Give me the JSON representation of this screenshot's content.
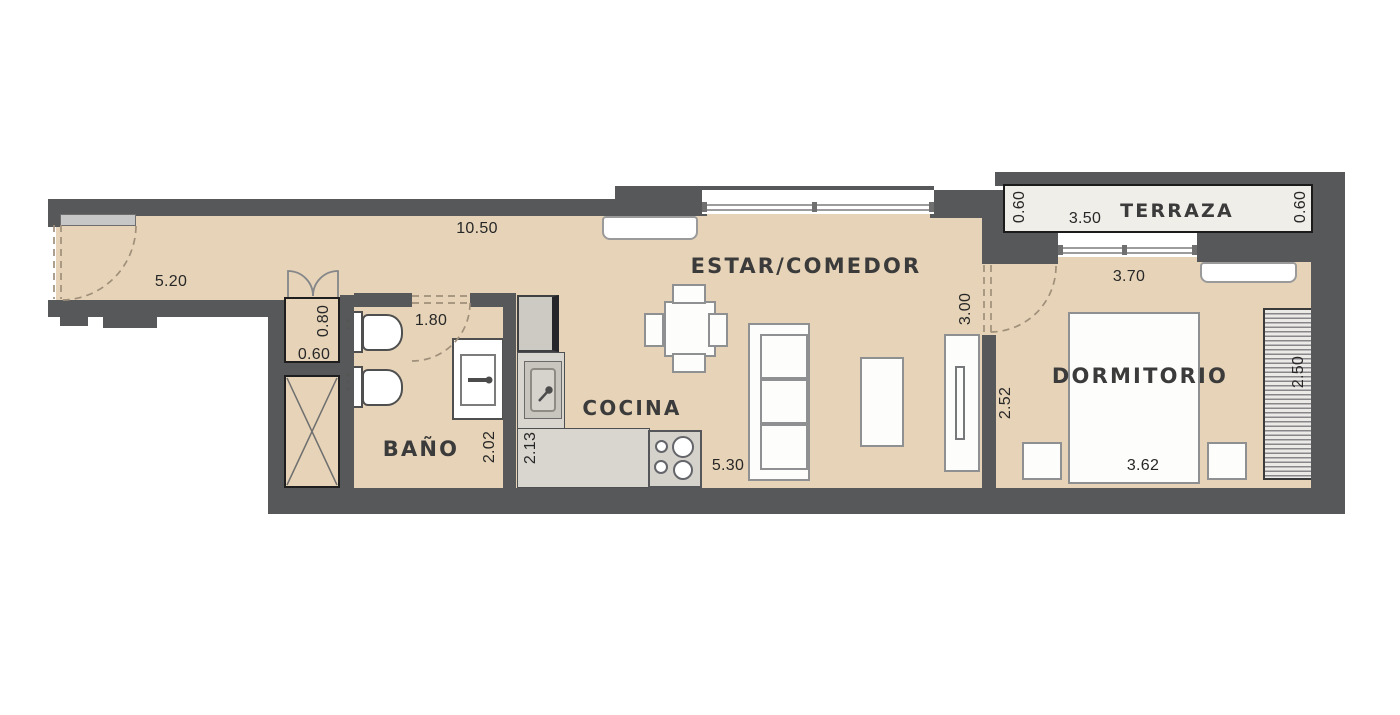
{
  "plan_title": "Apartment floor plan",
  "rooms": {
    "estar_comedor": "ESTAR/COMEDOR",
    "dormitorio": "DORMITORIO",
    "cocina": "COCINA",
    "bano": "BAÑO",
    "terraza": "TERRAZA"
  },
  "dims": {
    "entry_hall_length": "5.20",
    "living_strip_length": "10.50",
    "closet_depth": "0.80",
    "closet_width": "0.60",
    "bath_width": "1.80",
    "bath_depth": "2.02",
    "kitchen_depth": "2.13",
    "kitchen_living_length": "5.30",
    "bedroom_door_width": "3.00",
    "bedroom_depth": "2.52",
    "bed_wall_length": "3.62",
    "wardrobe_length": "2.50",
    "bedroom_window_width": "3.70",
    "terraza_depth_left": "0.60",
    "terraza_width": "3.50",
    "terraza_depth_right": "0.60"
  },
  "colors": {
    "floor": "#e7d4b8",
    "wall": "#57585a",
    "counter": "#d9d6d0",
    "terraza_floor": "#f0eee9",
    "furniture_outline": "#8f9092",
    "door_swing": "#a08f7a"
  }
}
